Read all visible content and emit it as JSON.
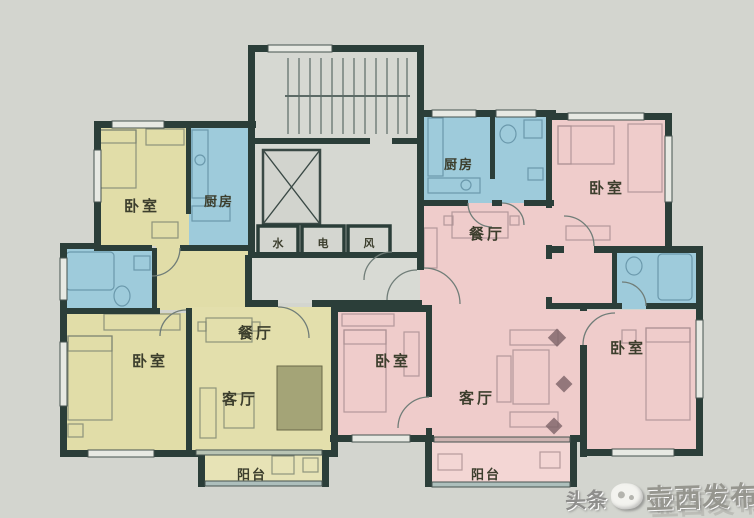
{
  "left_unit": {
    "bedroom_top": {
      "label": "卧室"
    },
    "kitchen": {
      "label": "厨房"
    },
    "bedroom_bottom": {
      "label": "卧室"
    },
    "dining": {
      "label": "餐厅"
    },
    "living": {
      "label": "客厅"
    },
    "balcony": {
      "label": "阳台"
    }
  },
  "right_unit": {
    "kitchen": {
      "label": "厨房"
    },
    "dining": {
      "label": "餐厅"
    },
    "bedroom_top": {
      "label": "卧室"
    },
    "bedroom_middle": {
      "label": "卧室"
    },
    "bedroom_bottom": {
      "label": "卧室"
    },
    "living": {
      "label": "客厅"
    },
    "balcony": {
      "label": "阳台"
    }
  },
  "core": {
    "shafts": {
      "water": "水",
      "electric": "电",
      "vent": "风"
    }
  },
  "watermark": {
    "site": "头条",
    "publisher": "壶西发布"
  },
  "colors": {
    "background": "#d3d5cf",
    "wall": "#2b3e39",
    "bedroom_yellow": "#e1dda8",
    "wet_area_blue": "#9ecbdb",
    "unit_pink": "#efcccb",
    "balcony_yellow": "#e7e3b6",
    "balcony_pink": "#f3d6d4",
    "core_gray": "#d6d8d2",
    "label_text": "#3c3e2d"
  }
}
